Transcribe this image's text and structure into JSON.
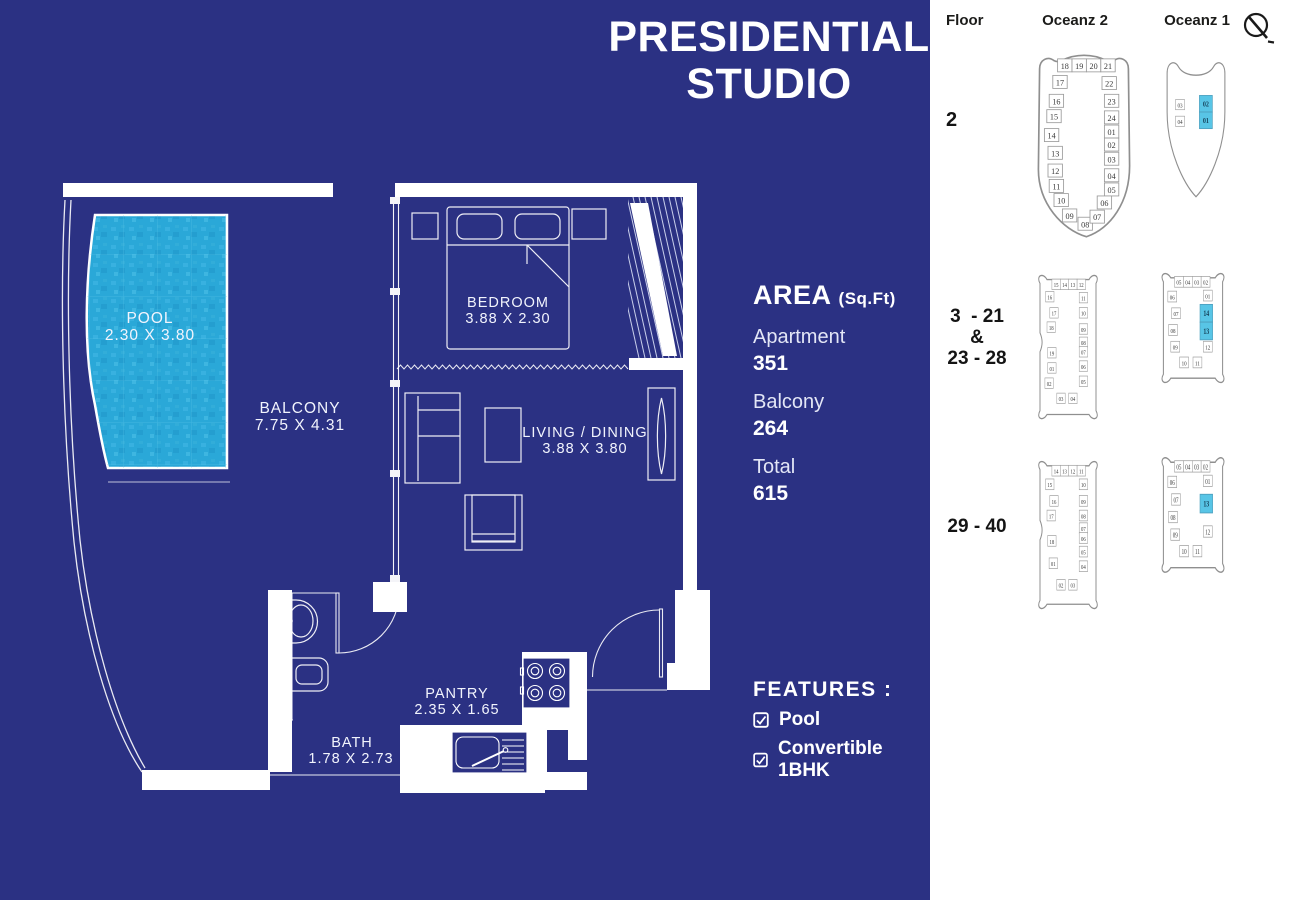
{
  "title": {
    "line1": "PRESIDENTIAL",
    "line2": "STUDIO"
  },
  "area": {
    "heading": "AREA",
    "heading_unit": "(Sq.Ft)",
    "items": [
      {
        "label": "Apartment",
        "value": "351"
      },
      {
        "label": "Balcony",
        "value": "264"
      },
      {
        "label": "Total",
        "value": "615"
      }
    ]
  },
  "features": {
    "heading": "FEATURES :",
    "items": [
      {
        "label": "Pool"
      },
      {
        "label": "Convertible 1BHK"
      }
    ]
  },
  "floorplan": {
    "rooms": [
      {
        "name": "POOL",
        "dims": "2.30 X 3.80"
      },
      {
        "name": "BALCONY",
        "dims": "7.75 X 4.31"
      },
      {
        "name": "BEDROOM",
        "dims": "3.88 X 2.30"
      },
      {
        "name": "LIVING / DINING",
        "dims": "3.88 X 3.80"
      },
      {
        "name": "PANTRY",
        "dims": "2.35 X 1.65"
      },
      {
        "name": "BATH",
        "dims": "1.78 X 2.73"
      }
    ]
  },
  "colors": {
    "background_blue": "#2b3183",
    "pool_cyan": "#2aa8d8",
    "highlight_cyan": "#58c5e6",
    "wall_white": "#ffffff",
    "diagram_stroke": "#8f8f8f",
    "panel_text": "#1c1c1c"
  },
  "locator": {
    "header": {
      "floor": "Floor",
      "oceanz2": "Oceanz 2",
      "oceanz1": "Oceanz 1"
    },
    "compass": "north-arrow",
    "rows": [
      {
        "floor_lines": [
          "2"
        ],
        "label_pos": {
          "left": 16,
          "top": 110,
          "width": 60,
          "align": "left"
        },
        "diagrams": [
          {
            "tower": "Oceanz 2",
            "shape": "boat2",
            "left": 94,
            "top": 50,
            "width": 120,
            "height": 195,
            "units": [
              {
                "n": "18",
                "x": 34,
                "y": 15
              },
              {
                "n": "19",
                "x": 46,
                "y": 15
              },
              {
                "n": "20",
                "x": 58,
                "y": 15
              },
              {
                "n": "21",
                "x": 70,
                "y": 15
              },
              {
                "n": "17",
                "x": 30,
                "y": 29
              },
              {
                "n": "22",
                "x": 71,
                "y": 30
              },
              {
                "n": "16",
                "x": 27,
                "y": 45
              },
              {
                "n": "23",
                "x": 73,
                "y": 45
              },
              {
                "n": "15",
                "x": 25,
                "y": 58
              },
              {
                "n": "24",
                "x": 73,
                "y": 59
              },
              {
                "n": "14",
                "x": 23,
                "y": 74
              },
              {
                "n": "01",
                "x": 73,
                "y": 71
              },
              {
                "n": "13",
                "x": 26,
                "y": 89
              },
              {
                "n": "02",
                "x": 73,
                "y": 82
              },
              {
                "n": "12",
                "x": 26,
                "y": 104
              },
              {
                "n": "03",
                "x": 73,
                "y": 94
              },
              {
                "n": "11",
                "x": 27,
                "y": 117
              },
              {
                "n": "04",
                "x": 73,
                "y": 108
              },
              {
                "n": "10",
                "x": 31,
                "y": 129
              },
              {
                "n": "05",
                "x": 73,
                "y": 120
              },
              {
                "n": "09",
                "x": 38,
                "y": 142
              },
              {
                "n": "06",
                "x": 67,
                "y": 131
              },
              {
                "n": "08",
                "x": 51,
                "y": 149
              },
              {
                "n": "07",
                "x": 61,
                "y": 143
              }
            ]
          },
          {
            "tower": "Oceanz 1",
            "shape": "boat1",
            "left": 228,
            "top": 54,
            "width": 76,
            "height": 152,
            "units": [
              {
                "n": "03",
                "x": 29,
                "y": 57
              },
              {
                "n": "04",
                "x": 29,
                "y": 75
              },
              {
                "n": "02",
                "x": 63,
                "y": 56,
                "hl": true
              },
              {
                "n": "01",
                "x": 63,
                "y": 74,
                "hl": true
              }
            ]
          }
        ]
      },
      {
        "floor_lines": [
          "3  - 21",
          "&",
          "23 - 28"
        ],
        "label_pos": {
          "left": 12,
          "top": 306,
          "width": 70,
          "align": "center"
        },
        "diagrams": [
          {
            "tower": "Oceanz 2",
            "shape": "cat2",
            "left": 103,
            "top": 272,
            "width": 70,
            "height": 152,
            "units": [
              {
                "n": "15",
                "x": 33,
                "y": 15
              },
              {
                "n": "14",
                "x": 45,
                "y": 15
              },
              {
                "n": "13",
                "x": 57,
                "y": 15
              },
              {
                "n": "12",
                "x": 69,
                "y": 15
              },
              {
                "n": "16",
                "x": 24,
                "y": 28
              },
              {
                "n": "11",
                "x": 72,
                "y": 29
              },
              {
                "n": "17",
                "x": 30,
                "y": 45
              },
              {
                "n": "10",
                "x": 72,
                "y": 45
              },
              {
                "n": "18",
                "x": 26,
                "y": 60
              },
              {
                "n": "09",
                "x": 72,
                "y": 62
              },
              {
                "n": "19",
                "x": 27,
                "y": 87
              },
              {
                "n": "08",
                "x": 72,
                "y": 76
              },
              {
                "n": "01",
                "x": 27,
                "y": 103
              },
              {
                "n": "07",
                "x": 72,
                "y": 86
              },
              {
                "n": "02",
                "x": 23,
                "y": 119
              },
              {
                "n": "06",
                "x": 72,
                "y": 101
              },
              {
                "n": "03",
                "x": 40,
                "y": 135
              },
              {
                "n": "05",
                "x": 72,
                "y": 117
              },
              {
                "n": "04",
                "x": 57,
                "y": 135
              }
            ]
          },
          {
            "tower": "Oceanz 1",
            "shape": "cat1",
            "left": 226,
            "top": 270,
            "width": 74,
            "height": 118,
            "units": [
              {
                "n": "05",
                "x": 31,
                "y": 14
              },
              {
                "n": "04",
                "x": 43,
                "y": 14
              },
              {
                "n": "03",
                "x": 55,
                "y": 14
              },
              {
                "n": "02",
                "x": 67,
                "y": 14
              },
              {
                "n": "06",
                "x": 22,
                "y": 29
              },
              {
                "n": "01",
                "x": 70,
                "y": 28
              },
              {
                "n": "07",
                "x": 27,
                "y": 46
              },
              {
                "n": "14",
                "x": 68,
                "y": 46,
                "hl": true
              },
              {
                "n": "08",
                "x": 23,
                "y": 63
              },
              {
                "n": "13",
                "x": 68,
                "y": 64,
                "hl": true
              },
              {
                "n": "09",
                "x": 26,
                "y": 80
              },
              {
                "n": "12",
                "x": 70,
                "y": 80
              },
              {
                "n": "10",
                "x": 38,
                "y": 96
              },
              {
                "n": "11",
                "x": 56,
                "y": 96
              }
            ]
          }
        ]
      },
      {
        "floor_lines": [
          "29 - 40"
        ],
        "label_pos": {
          "left": 12,
          "top": 516,
          "width": 70,
          "align": "center"
        },
        "diagrams": [
          {
            "tower": "Oceanz 2",
            "shape": "cat2",
            "left": 103,
            "top": 458,
            "width": 70,
            "height": 156,
            "units": [
              {
                "n": "14",
                "x": 33,
                "y": 15
              },
              {
                "n": "13",
                "x": 45,
                "y": 15
              },
              {
                "n": "12",
                "x": 57,
                "y": 15
              },
              {
                "n": "11",
                "x": 69,
                "y": 15
              },
              {
                "n": "15",
                "x": 24,
                "y": 29
              },
              {
                "n": "10",
                "x": 72,
                "y": 29
              },
              {
                "n": "16",
                "x": 30,
                "y": 46
              },
              {
                "n": "09",
                "x": 72,
                "y": 46
              },
              {
                "n": "17",
                "x": 26,
                "y": 61
              },
              {
                "n": "08",
                "x": 72,
                "y": 61
              },
              {
                "n": "18",
                "x": 27,
                "y": 87
              },
              {
                "n": "07",
                "x": 72,
                "y": 74
              },
              {
                "n": "01",
                "x": 29,
                "y": 110
              },
              {
                "n": "06",
                "x": 72,
                "y": 84
              },
              {
                "n": "02",
                "x": 40,
                "y": 132
              },
              {
                "n": "05",
                "x": 72,
                "y": 98
              },
              {
                "n": "03",
                "x": 57,
                "y": 132
              },
              {
                "n": "04",
                "x": 72,
                "y": 113
              }
            ]
          },
          {
            "tower": "Oceanz 1",
            "shape": "cat1",
            "left": 226,
            "top": 454,
            "width": 74,
            "height": 124,
            "units": [
              {
                "n": "05",
                "x": 31,
                "y": 14
              },
              {
                "n": "04",
                "x": 43,
                "y": 14
              },
              {
                "n": "03",
                "x": 55,
                "y": 14
              },
              {
                "n": "02",
                "x": 67,
                "y": 14
              },
              {
                "n": "06",
                "x": 22,
                "y": 29
              },
              {
                "n": "01",
                "x": 70,
                "y": 28
              },
              {
                "n": "07",
                "x": 27,
                "y": 46
              },
              {
                "n": "13",
                "x": 68,
                "y": 50,
                "hl": true
              },
              {
                "n": "08",
                "x": 23,
                "y": 63
              },
              {
                "n": "12",
                "x": 70,
                "y": 77
              },
              {
                "n": "09",
                "x": 26,
                "y": 80
              },
              {
                "n": "10",
                "x": 38,
                "y": 96
              },
              {
                "n": "11",
                "x": 56,
                "y": 96
              }
            ]
          }
        ]
      }
    ]
  }
}
